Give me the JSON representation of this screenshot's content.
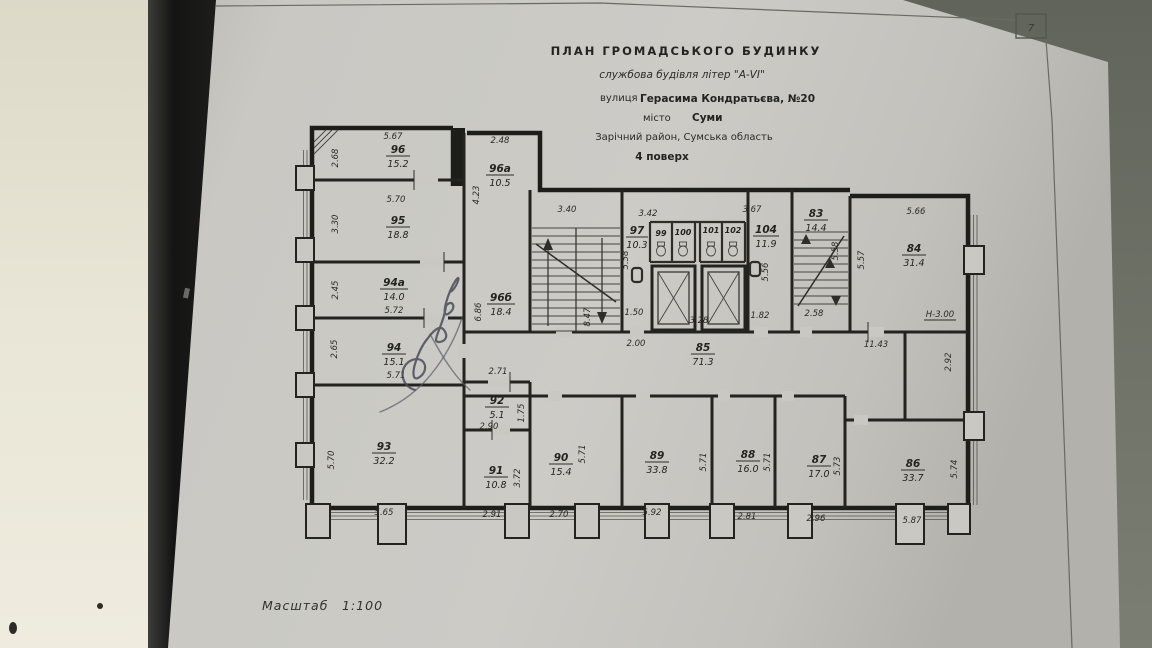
{
  "photo": {
    "background_color": "#70746a",
    "wall_color": "#ebe8da",
    "shadow_strip_color": "#141414",
    "paper_color": "#c9c8c3"
  },
  "sheet": {
    "page_marker": "7",
    "scale_label": "Масштаб",
    "scale_value": "1:100"
  },
  "title_block": {
    "line1": "ПЛАН  ГРОМАДСЬКОГО  БУДИНКУ",
    "line2": "службова будівля літер \"А-VI\"",
    "street_label": "вулиця",
    "street_value": "Герасима Кондратьєва, №20",
    "city_label": "місто",
    "city_value": "Суми",
    "district": "Зарічний район, Сумська область",
    "floor": "4 поверх"
  },
  "annotations": {
    "height_mark": "Н-3.00"
  },
  "rooms": {
    "r96": {
      "num": "96",
      "area": "15.2"
    },
    "r96a": {
      "num": "96а",
      "area": "10.5"
    },
    "r95": {
      "num": "95",
      "area": "18.8"
    },
    "r94a": {
      "num": "94а",
      "area": "14.0"
    },
    "r94": {
      "num": "94",
      "area": "15.1"
    },
    "r96b": {
      "num": "96б",
      "area": "18.4"
    },
    "r93": {
      "num": "93",
      "area": "32.2"
    },
    "r92": {
      "num": "92",
      "area": "5.1"
    },
    "r91": {
      "num": "91",
      "area": "10.8"
    },
    "r90": {
      "num": "90",
      "area": "15.4"
    },
    "r89": {
      "num": "89",
      "area": "33.8"
    },
    "r88": {
      "num": "88",
      "area": "16.0"
    },
    "r87": {
      "num": "87",
      "area": "17.0"
    },
    "r86": {
      "num": "86",
      "area": "33.7"
    },
    "r97": {
      "num": "97",
      "area": "10.3"
    },
    "r99": {
      "num": "99"
    },
    "r100": {
      "num": "100"
    },
    "r101": {
      "num": "101"
    },
    "r102": {
      "num": "102"
    },
    "r104": {
      "num": "104",
      "area": "11.9"
    },
    "r83": {
      "num": "83",
      "area": "14.4"
    },
    "r84": {
      "num": "84",
      "area": "31.4"
    },
    "r85": {
      "num": "85",
      "area": "71.3"
    }
  },
  "dims": {
    "top96": "5.67",
    "h96": "2.68",
    "top96a": "2.48",
    "h96a": "4.23",
    "w95": "5.70",
    "h95": "3.30",
    "h94a": "2.45",
    "w94a": "5.72",
    "h94": "2.65",
    "w94": "5.71",
    "h96b": "6.86",
    "w96b": "2.71",
    "stair1": "3.40",
    "w97": "3.42",
    "w104top": "3.67",
    "h97": "5.58",
    "hstair": "8.47",
    "d150": "1.50",
    "d200": "2.00",
    "d328": "3.28",
    "d182": "1.82",
    "h104": "5.56",
    "d258": "2.58",
    "h83": "5.58",
    "h84l": "5.57",
    "w84": "5.66",
    "d1143": "11.43",
    "h292": "2.92",
    "w92": "2.90",
    "h92": "1.75",
    "h91": "3.72",
    "w91": "2.91",
    "h90": "5.71",
    "w90": "2.70",
    "h89": "5.71",
    "w89": "5.92",
    "h88": "5.71",
    "w88": "2.81",
    "h87": "5.73",
    "w87": "2.96",
    "h86": "5.74",
    "w86": "5.87",
    "h93": "5.70",
    "w93": "5.65"
  }
}
